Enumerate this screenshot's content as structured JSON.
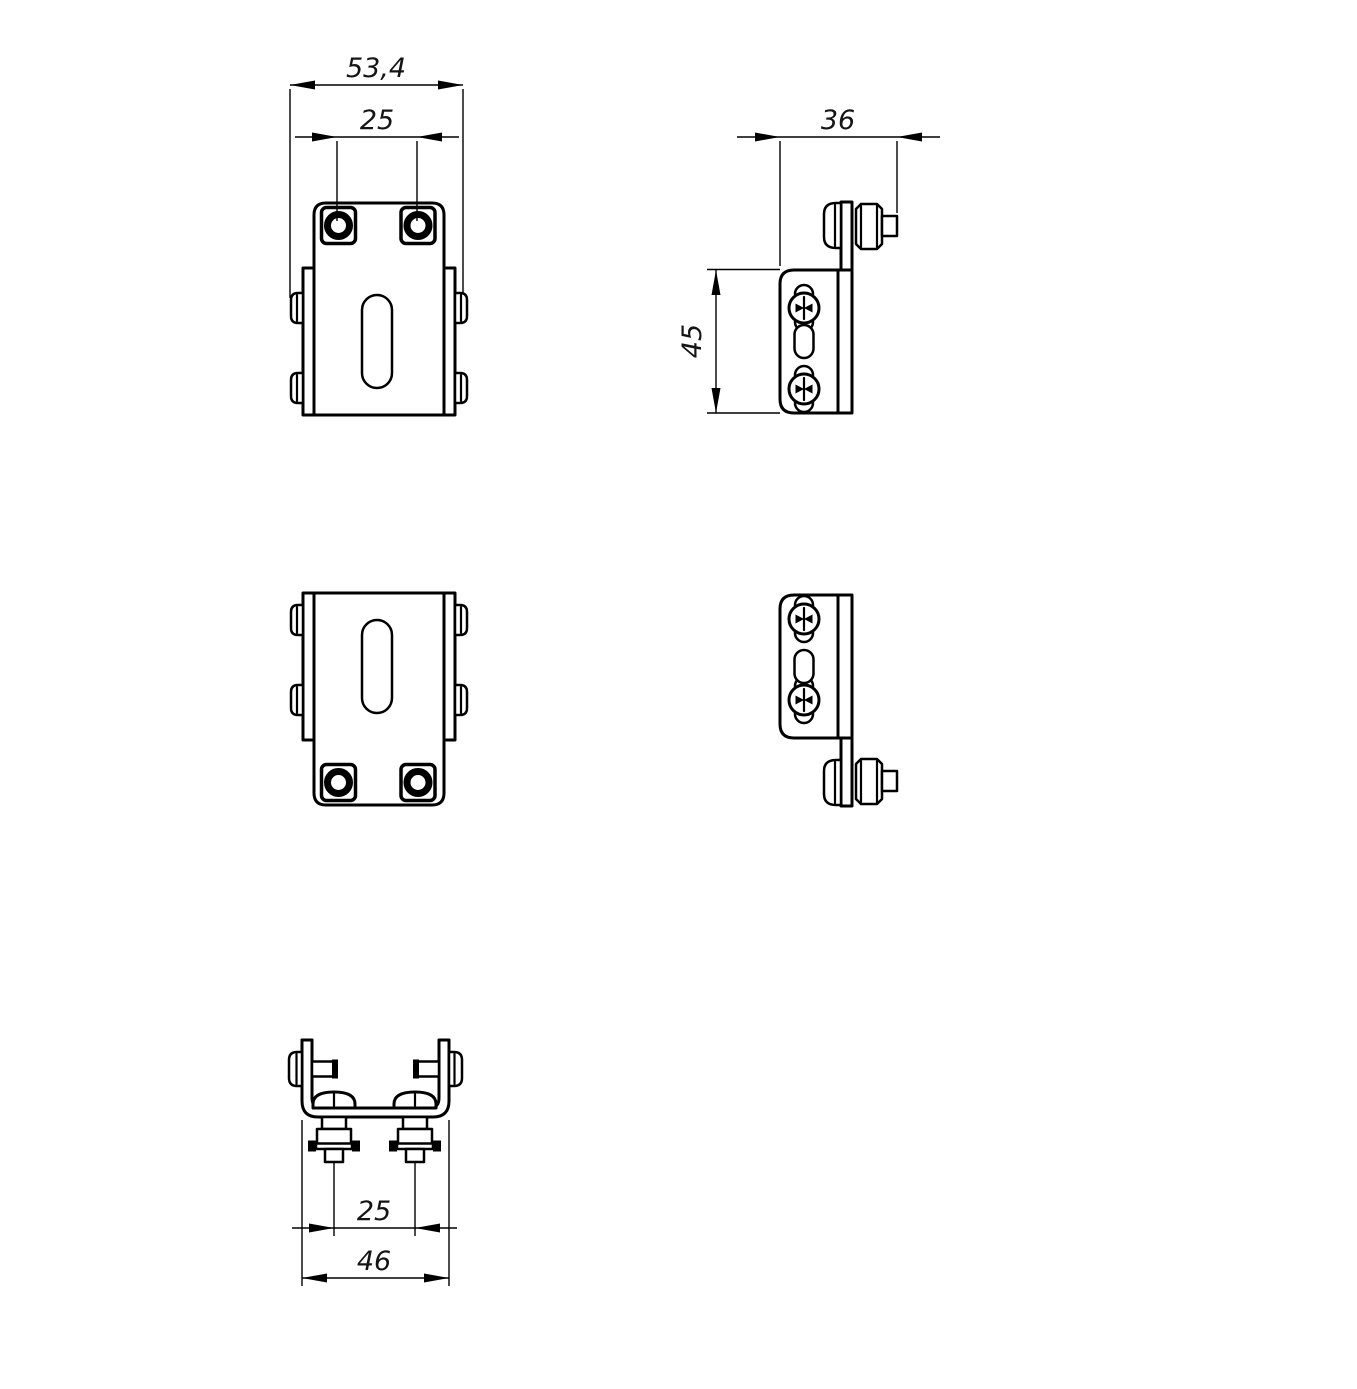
{
  "drawing": {
    "type": "technical-orthographic-views",
    "part": "mounting bracket with weld studs and screws",
    "ink_color": "#000000",
    "background_color": "#ffffff",
    "views": {
      "front_top": "front view, studs up",
      "side_top": "side view, bolt up",
      "front_bottom": "front view, studs down",
      "side_bottom": "side view, bolt down",
      "bottom": "top view of channel with studs"
    }
  },
  "dims": {
    "front_overall_width": "53,4",
    "front_hole_spacing": "25",
    "side_depth": "36",
    "side_height": "45",
    "bottom_stud_spacing": "25",
    "bottom_overall_width": "46"
  }
}
